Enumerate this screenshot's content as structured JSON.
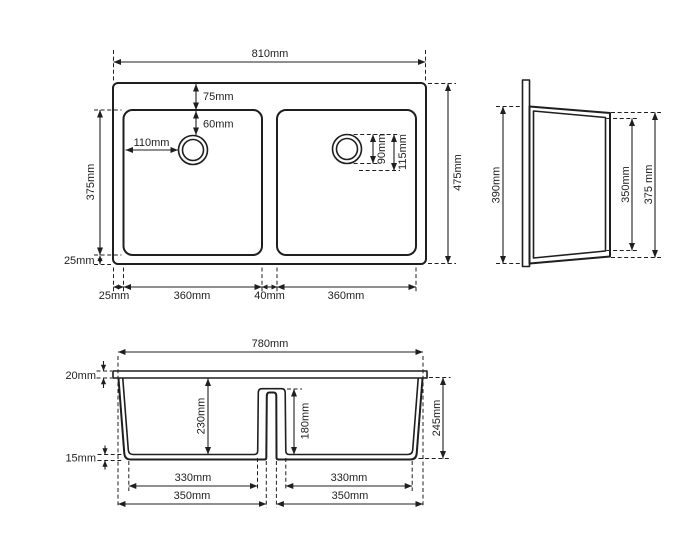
{
  "drawing": {
    "subject": "double-bowl-sink-technical-drawing",
    "line_color": "#1f1f1f",
    "background": "#ffffff",
    "views": {
      "top": {
        "width": "810mm",
        "depth": "475mm",
        "rim_top": "75mm",
        "hole_offset_y": "60mm",
        "hole_offset_x": "110mm",
        "bowl_depth": "375mm",
        "rim_bottom": "25mm",
        "rim_left": "25mm",
        "bowl1_width": "360mm",
        "divider": "40mm",
        "bowl2_width": "360mm",
        "hole_d1": "90mm",
        "hole_d2": "115mm"
      },
      "side": {
        "height": "390mm",
        "inner_depth": "350mm",
        "outer_depth": "375 mm"
      },
      "front": {
        "width": "780mm",
        "rim": "20mm",
        "bowl_depth": "230mm",
        "divider_depth": "180mm",
        "base": "15mm",
        "height": "245mm",
        "bowl1_inner": "330mm",
        "bowl2_inner": "330mm",
        "bowl1_outer": "350mm",
        "bowl2_outer": "350mm"
      }
    }
  }
}
